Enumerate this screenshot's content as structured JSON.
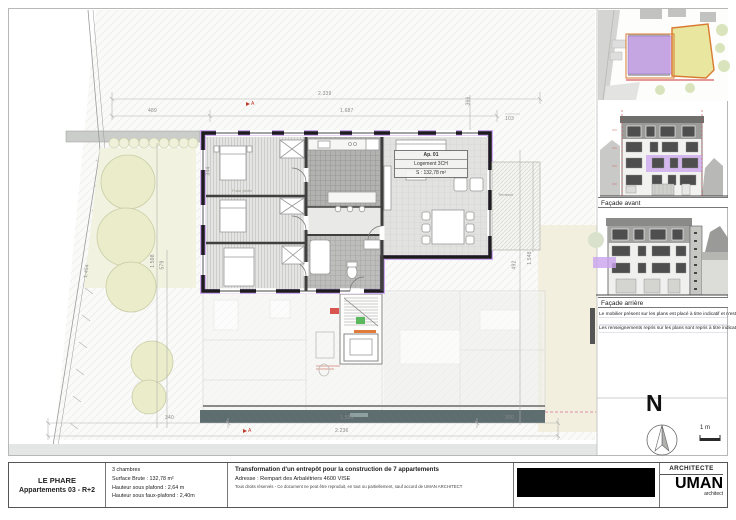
{
  "colors": {
    "purple_highlight": "#cfa9f2",
    "wall_black": "#1c1c1c",
    "garden_green": "#eef0d2",
    "parcel_yellow": "#e9e6a0",
    "parcel_orange": "#d97a2e",
    "road_dark": "#5d6d70",
    "red_marker": "#c03a2b"
  },
  "plan": {
    "apartment": {
      "id": "Ap. 01",
      "type": "Logement 3CH",
      "surface": "S : 132,78 m²"
    },
    "labels": {
      "terrace": "Terrasse",
      "garden": "Futur jardin"
    },
    "markers": {
      "top": "A",
      "bottom": "A"
    },
    "dims": {
      "top_total": "2.339",
      "top_left": "489",
      "top_mid": "1.687",
      "top_right": "366",
      "right_top": "103",
      "right_1": "492",
      "right_2": "1.548",
      "left_1": "1.598",
      "left_2": "579",
      "left_diag": "1.454",
      "garden": "344",
      "bottom_1": "340",
      "bottom_2": "1.596",
      "bottom_3": "300",
      "bottom_total": "2.236"
    }
  },
  "elevations": {
    "front": "Façade avant",
    "rear": "Façade arrière"
  },
  "notes": {
    "p1": "Le mobilier présent sur les plans est placé à titre indicatif et n'est pas compris dans la vente. Seul le mobilier de cuisine, les équipements sanitaires ainsi que le mobilier dans lesquels ils s'intègrent sont prévus.",
    "p2": "Les renseignements repris sur les plans sont repris à titre indicatif et sont non contractuels. Bien que faisant l'objet d'une attention particulière, les informations sont données sous réserve d'erreurs de saisie et/ou de modifications éventuelles."
  },
  "compass": {
    "north": "N",
    "scale": "1 m"
  },
  "titleblock": {
    "project_name": "LE PHARE",
    "unit_line": "Appartements 03 - R+2",
    "specs": [
      "3 chambres",
      "Surface Brute : 132,78 m²",
      "Hauteur sous plafond : 2,64 m",
      "Hauteur sous faux-plafond : 2,40m"
    ],
    "description": "Transformation d'un entrepôt pour la construction de 7 appartements",
    "address": "Adresse : Rempart des Arbalétriers 4600 VISE",
    "copyright": "Tous droits réservés - Ce document ne peut être reproduit, en tout ou partiellement, sauf accord de UMAN ARCHITECT",
    "architect_heading": "ARCHITECTE",
    "logo_main": "UMAN",
    "logo_sub": "architect"
  }
}
